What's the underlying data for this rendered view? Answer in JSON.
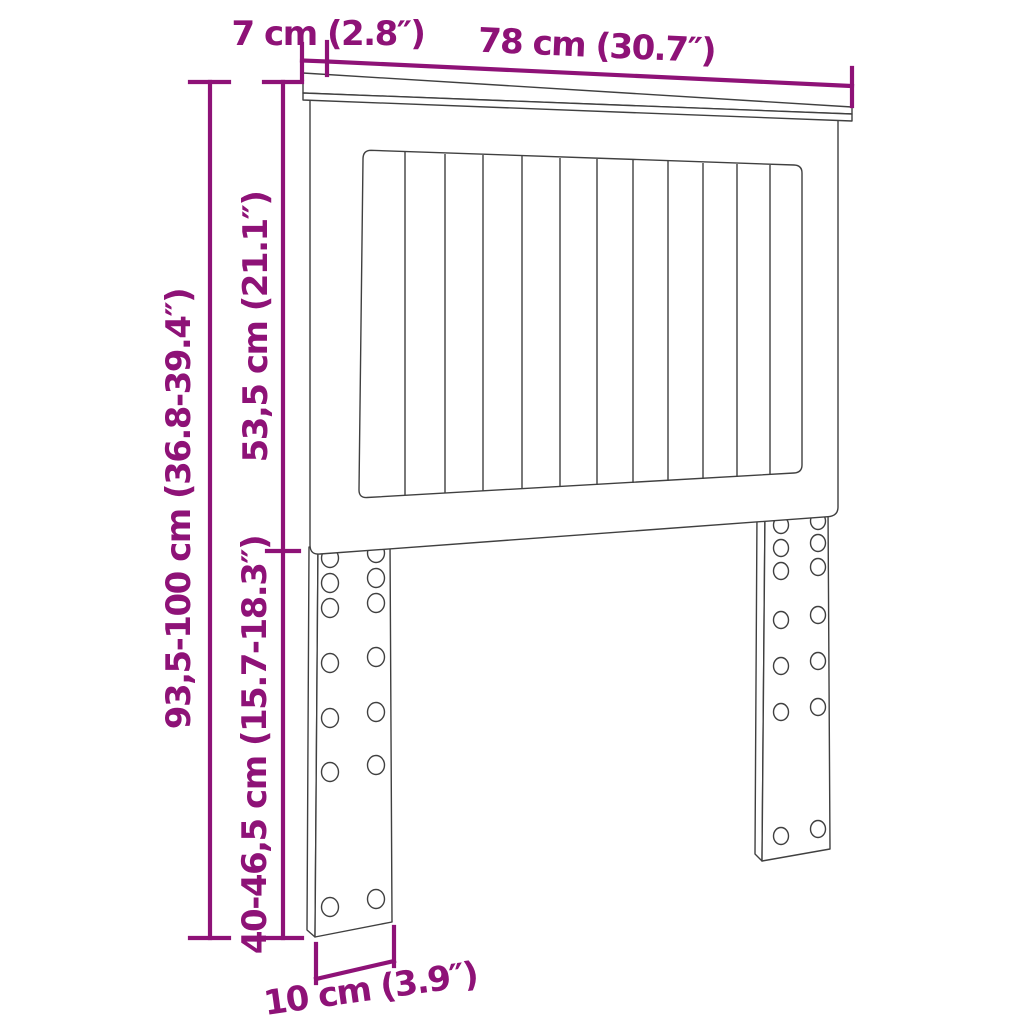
{
  "diagram": {
    "kind": "furniture-dimension-diagram",
    "subject": "headboard-with-slats-and-pre-drilled-legs",
    "colors": {
      "dimension_accent": "#8E1277",
      "outline": "#404040",
      "background": "#FFFFFF"
    },
    "dimensions": {
      "shelf_depth": "7 cm (2.8″)",
      "width": "78 cm (30.7″)",
      "panel_height": "53,5 cm (21.1″)",
      "total_height": "93,5-100 cm (36.8-39.4″)",
      "leg_height": "40-46,5 cm (15.7-18.3″)",
      "leg_width": "10 cm (3.9″)"
    }
  }
}
